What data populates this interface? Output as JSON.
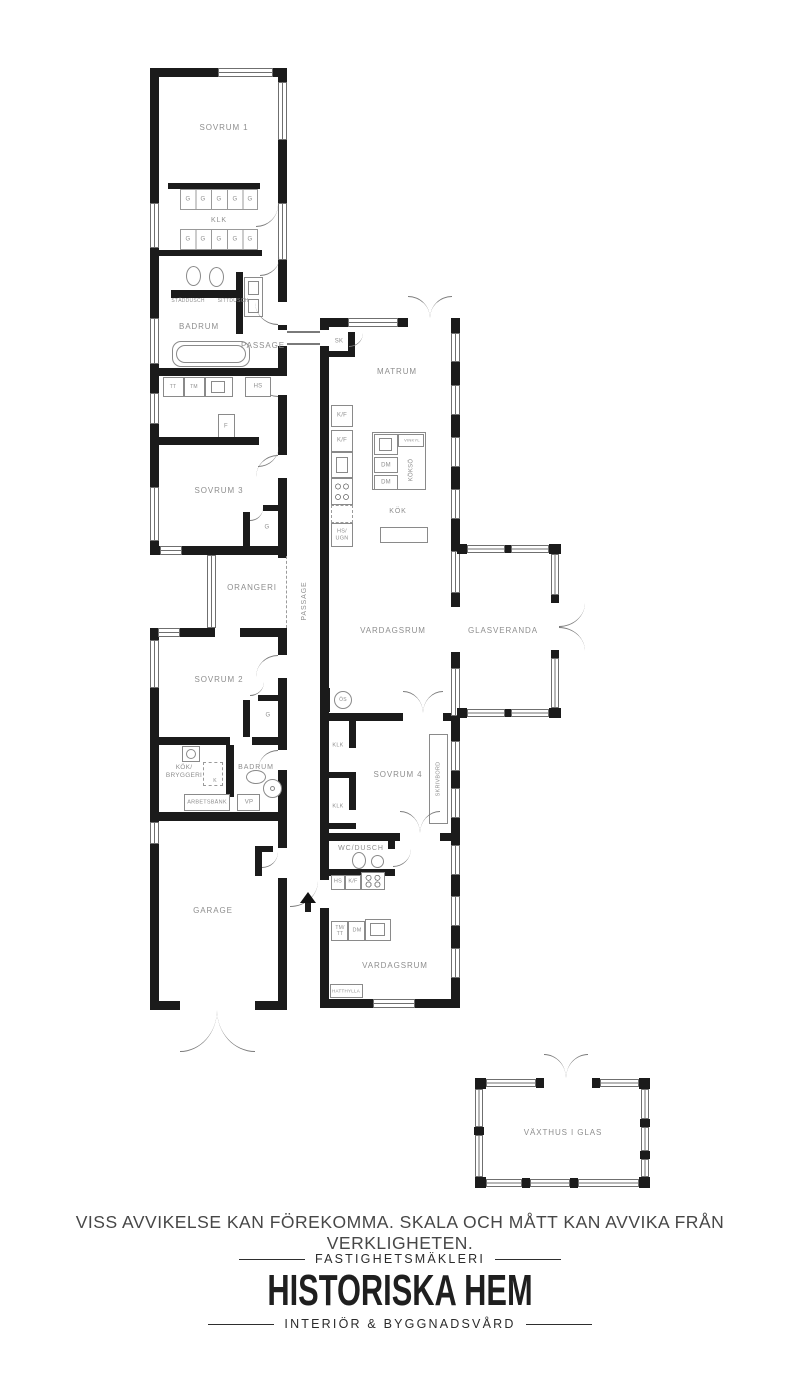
{
  "plan": {
    "colors": {
      "wall": "#1b1b1b",
      "fixture_line": "#8a8a8a",
      "label": "#8e8e8e",
      "window_line": "#6f6f6f"
    },
    "labels": [
      {
        "name": "room-label-sovrum-1",
        "text": "SOVRUM 1",
        "x": 224,
        "y": 128,
        "fs": 8
      },
      {
        "name": "wardrobe-label-g",
        "text": "G",
        "x": 188,
        "y": 200,
        "fs": 6
      },
      {
        "name": "wardrobe-label-g",
        "text": "G",
        "x": 203,
        "y": 200,
        "fs": 6
      },
      {
        "name": "wardrobe-label-g",
        "text": "G",
        "x": 219,
        "y": 200,
        "fs": 6
      },
      {
        "name": "wardrobe-label-g",
        "text": "G",
        "x": 235,
        "y": 200,
        "fs": 6
      },
      {
        "name": "wardrobe-label-g",
        "text": "G",
        "x": 250,
        "y": 200,
        "fs": 6
      },
      {
        "name": "room-label-klk",
        "text": "KLK",
        "x": 219,
        "y": 221,
        "fs": 7
      },
      {
        "name": "wardrobe-label-g",
        "text": "G",
        "x": 188,
        "y": 240,
        "fs": 6
      },
      {
        "name": "wardrobe-label-g",
        "text": "G",
        "x": 203,
        "y": 240,
        "fs": 6
      },
      {
        "name": "wardrobe-label-g",
        "text": "G",
        "x": 219,
        "y": 240,
        "fs": 6
      },
      {
        "name": "wardrobe-label-g",
        "text": "G",
        "x": 235,
        "y": 240,
        "fs": 6
      },
      {
        "name": "wardrobe-label-g",
        "text": "G",
        "x": 250,
        "y": 240,
        "fs": 6
      },
      {
        "name": "fixture-label-staddusch",
        "text": "STÄDDUSCH",
        "x": 188,
        "y": 301,
        "fs": 5
      },
      {
        "name": "fixture-label-sittdusch",
        "text": "SITTDUSCH",
        "x": 233,
        "y": 301,
        "fs": 5
      },
      {
        "name": "room-label-badrum-1",
        "text": "BADRUM",
        "x": 199,
        "y": 327,
        "fs": 8
      },
      {
        "name": "room-label-passage-1",
        "text": "PASSAGE",
        "x": 263,
        "y": 346,
        "fs": 8
      },
      {
        "name": "fixture-label-tt",
        "text": "TT",
        "x": 173,
        "y": 387,
        "fs": 5
      },
      {
        "name": "fixture-label-tm",
        "text": "TM",
        "x": 194,
        "y": 387,
        "fs": 5
      },
      {
        "name": "fixture-label-hs-1",
        "text": "HS",
        "x": 258,
        "y": 387,
        "fs": 6
      },
      {
        "name": "fixture-label-f",
        "text": "F",
        "x": 226,
        "y": 427,
        "fs": 6
      },
      {
        "name": "room-label-sk",
        "text": "SK",
        "x": 339,
        "y": 342,
        "fs": 6
      },
      {
        "name": "room-label-matrum",
        "text": "MATRUM",
        "x": 397,
        "y": 372,
        "fs": 8
      },
      {
        "name": "fixture-label-kf-1",
        "text": "K/F",
        "x": 342,
        "y": 416,
        "fs": 6
      },
      {
        "name": "fixture-label-kf-2",
        "text": "K/F",
        "x": 342,
        "y": 441,
        "fs": 6
      },
      {
        "name": "fixture-label-hs-ugn",
        "text": "HS/\nUGN",
        "x": 342,
        "y": 535,
        "fs": 5.5
      },
      {
        "name": "fixture-label-vinkyl",
        "text": "VINKYL",
        "x": 412,
        "y": 441,
        "fs": 4
      },
      {
        "name": "fixture-label-dm-1",
        "text": "DM",
        "x": 386,
        "y": 466,
        "fs": 6
      },
      {
        "name": "fixture-label-dm-2",
        "text": "DM",
        "x": 386,
        "y": 483,
        "fs": 6
      },
      {
        "name": "fixture-label-kokso",
        "text": "KÖKSÖ",
        "x": 412,
        "y": 470,
        "fs": 6,
        "rot": -90
      },
      {
        "name": "room-label-kok",
        "text": "KÖK",
        "x": 398,
        "y": 512,
        "fs": 7
      },
      {
        "name": "room-label-sovrum-3",
        "text": "SOVRUM 3",
        "x": 219,
        "y": 491,
        "fs": 8
      },
      {
        "name": "wardrobe-label-g-sovrum3",
        "text": "G",
        "x": 267,
        "y": 528,
        "fs": 6
      },
      {
        "name": "room-label-orangeri",
        "text": "ORANGERI",
        "x": 252,
        "y": 588,
        "fs": 8
      },
      {
        "name": "room-label-passage-2",
        "text": "PASSAGE",
        "x": 305,
        "y": 601,
        "fs": 7,
        "rot": -90
      },
      {
        "name": "room-label-vardagsrum-1",
        "text": "VARDAGSRUM",
        "x": 393,
        "y": 631,
        "fs": 8
      },
      {
        "name": "room-label-glasveranda",
        "text": "GLASVERANDA",
        "x": 503,
        "y": 631,
        "fs": 8
      },
      {
        "name": "fixture-label-os",
        "text": "ÖS",
        "x": 343,
        "y": 700,
        "fs": 5
      },
      {
        "name": "room-label-sovrum-2",
        "text": "SOVRUM 2",
        "x": 219,
        "y": 680,
        "fs": 8
      },
      {
        "name": "wardrobe-label-g-sovrum2",
        "text": "G",
        "x": 268,
        "y": 716,
        "fs": 6
      },
      {
        "name": "room-label-kok-bryggeri",
        "text": "KÖK/\nBRYGGERI",
        "x": 184,
        "y": 772,
        "fs": 6.5
      },
      {
        "name": "fixture-label-k",
        "text": "K",
        "x": 215,
        "y": 781,
        "fs": 5
      },
      {
        "name": "room-label-badrum-2",
        "text": "BADRUM",
        "x": 256,
        "y": 768,
        "fs": 7
      },
      {
        "name": "fixture-label-arbetsbank",
        "text": "ARBETSBÄNK",
        "x": 207,
        "y": 803,
        "fs": 5.5
      },
      {
        "name": "fixture-label-vp",
        "text": "VP",
        "x": 249,
        "y": 803,
        "fs": 6
      },
      {
        "name": "room-label-garage",
        "text": "GARAGE",
        "x": 213,
        "y": 911,
        "fs": 8
      },
      {
        "name": "room-label-sovrum-4",
        "text": "SOVRUM 4",
        "x": 398,
        "y": 775,
        "fs": 8
      },
      {
        "name": "fixture-label-klk-1",
        "text": "KLK",
        "x": 338,
        "y": 746,
        "fs": 5.5
      },
      {
        "name": "fixture-label-klk-2",
        "text": "KLK",
        "x": 338,
        "y": 807,
        "fs": 5.5
      },
      {
        "name": "fixture-label-skrivbord",
        "text": "SKRIVBORD",
        "x": 439,
        "y": 779,
        "fs": 5.5,
        "rot": -90
      },
      {
        "name": "room-label-wc-dusch",
        "text": "WC/DUSCH",
        "x": 361,
        "y": 849,
        "fs": 7
      },
      {
        "name": "fixture-label-hs-2",
        "text": "HS",
        "x": 338,
        "y": 882,
        "fs": 5.5
      },
      {
        "name": "fixture-label-kf-3",
        "text": "K/F",
        "x": 353,
        "y": 882,
        "fs": 5.5
      },
      {
        "name": "fixture-label-tm-tt",
        "text": "TM/\nTT",
        "x": 340,
        "y": 931,
        "fs": 5
      },
      {
        "name": "fixture-label-dm-3",
        "text": "DM",
        "x": 357,
        "y": 931,
        "fs": 5.5
      },
      {
        "name": "room-label-vardagsrum-2",
        "text": "VARDAGSRUM",
        "x": 395,
        "y": 966,
        "fs": 8
      },
      {
        "name": "fixture-label-hatthylla",
        "text": "HATTHYLLA",
        "x": 346,
        "y": 991,
        "fs": 4.5
      },
      {
        "name": "room-label-vaxthus",
        "text": "VÄXTHUS I GLAS",
        "x": 563,
        "y": 1133,
        "fs": 8
      }
    ]
  },
  "footer": {
    "disclaimer": "VISS AVVIKELSE KAN FÖREKOMMA. SKALA OCH MÅTT KAN AVVIKA FRÅN VERKLIGHETEN.",
    "brand": {
      "tagline_top": "FASTIGHETSMÄKLERI",
      "name": "HISTORISKA HEM",
      "tagline_bottom": "INTERIÖR & BYGGNADSVÅRD"
    }
  }
}
